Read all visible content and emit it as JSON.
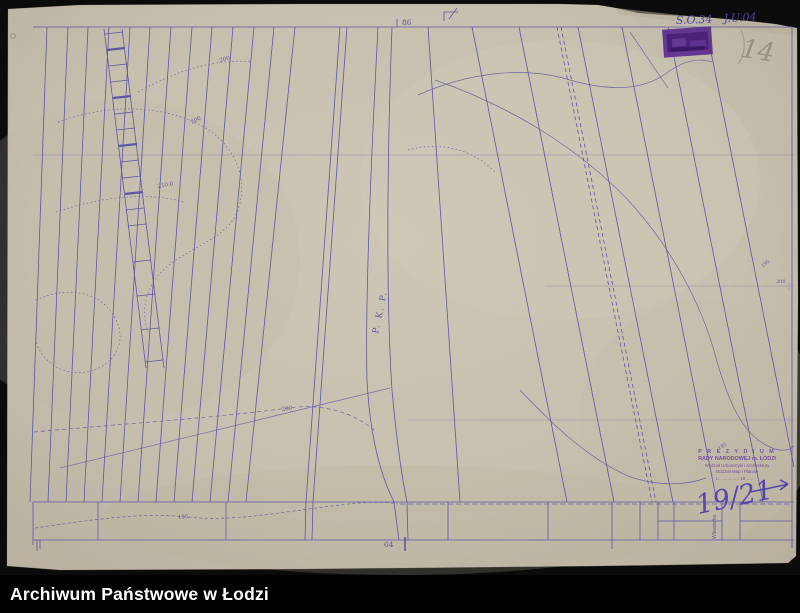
{
  "archive_bar": {
    "label": "Archiwum Państwowe w Łodzi"
  },
  "annotations": {
    "catalog_code": "S.O.34",
    "catalog_code2": "J.U.04",
    "pencil_mark": "14",
    "sheet_mark_top": "86",
    "sheet_mark_bottom": "64",
    "reference_number": "19/21"
  },
  "map": {
    "railway_label": "P. K. P.",
    "stream_label": "Wilanówka",
    "contour_labels": [
      {
        "text": "200"
      },
      {
        "text": "200"
      },
      {
        "text": "210.0"
      },
      {
        "text": "200"
      },
      {
        "text": "195"
      },
      {
        "text": "195"
      },
      {
        "text": "200"
      },
      {
        "text": "195"
      }
    ]
  },
  "stamp": {
    "line1": "P R E Z Y D I U M",
    "line2": "RADY NARODOWEJ m. ŁODZI",
    "line3": "Wydział Urbanistyki i Architektury",
    "line4": "Oddział Map i Planów",
    "line5": "L. ..............  19 ....."
  },
  "colors": {
    "ink": "#5e57a4",
    "paper": "#c9c2b1",
    "stamp_purple": "#5b2b8d",
    "handwriting": "#4a41a8"
  }
}
